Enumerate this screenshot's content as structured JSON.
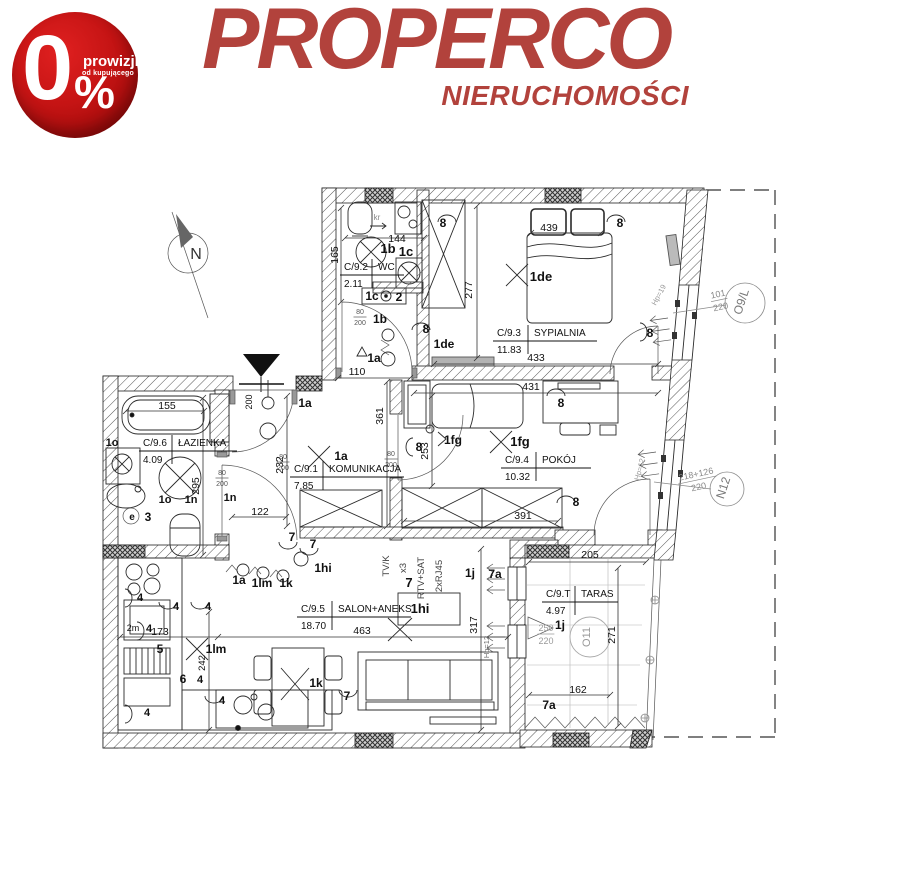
{
  "badge": {
    "zero": "0",
    "percent_sign": "%",
    "line1": "prowizji",
    "line2": "od kupującego",
    "bg": "#c51414"
  },
  "logo": {
    "title": "PROPERCO",
    "subtitle": "NIERUCHOMOŚCI",
    "color": "#b2423c"
  },
  "plan": {
    "compass_label": "N",
    "rooms": [
      {
        "code": "C/9.2",
        "name": "WC",
        "area": "2.11",
        "x": 344,
        "y": 270,
        "dx": 34,
        "lw": 60
      },
      {
        "code": "C/9.3",
        "name": "SYPIALNIA",
        "area": "11.83",
        "x": 497,
        "y": 336,
        "dx": 37,
        "lw": 100
      },
      {
        "code": "C/9.4",
        "name": "POKÓJ",
        "area": "10.32",
        "x": 505,
        "y": 463,
        "dx": 37,
        "lw": 86
      },
      {
        "code": "C/9.6",
        "name": "ŁAZIENKA",
        "area": "4.09",
        "x": 143,
        "y": 446,
        "dx": 35,
        "lw": 94
      },
      {
        "code": "C/9.1",
        "name": "KOMUNIKACJA",
        "area": "7.85",
        "x": 294,
        "y": 472,
        "dx": 35,
        "lw": 110
      },
      {
        "code": "C/9.5",
        "name": "SALON+ANEKS",
        "area": "18.70",
        "x": 301,
        "y": 612,
        "dx": 37,
        "lw": 110
      },
      {
        "code": "C/9.T",
        "name": "TARAS",
        "area": "4.97",
        "x": 546,
        "y": 597,
        "dx": 35,
        "lw": 72
      }
    ],
    "labels": [
      {
        "t": "144",
        "x": 397,
        "y": 242
      },
      {
        "t": "165",
        "x": 338,
        "y": 255,
        "r": -90
      },
      {
        "t": "110",
        "x": 357,
        "y": 375
      },
      {
        "t": "439",
        "x": 549,
        "y": 231
      },
      {
        "t": "277",
        "x": 472,
        "y": 290,
        "r": -90
      },
      {
        "t": "433",
        "x": 536,
        "y": 361
      },
      {
        "t": "431",
        "x": 531,
        "y": 390
      },
      {
        "t": "253",
        "x": 428,
        "y": 451,
        "r": -90
      },
      {
        "t": "361",
        "x": 383,
        "y": 416,
        "r": -90
      },
      {
        "t": "391",
        "x": 523,
        "y": 519
      },
      {
        "t": "155",
        "x": 167,
        "y": 409
      },
      {
        "t": "295",
        "x": 199,
        "y": 486,
        "r": -90
      },
      {
        "t": "232",
        "x": 283,
        "y": 465,
        "r": -90
      },
      {
        "t": "122",
        "x": 260,
        "y": 515
      },
      {
        "t": "200",
        "x": 252,
        "y": 402,
        "r": -90,
        "s": 9
      },
      {
        "t": "173",
        "x": 160,
        "y": 635
      },
      {
        "t": "242",
        "x": 205,
        "y": 663,
        "r": -90,
        "s": 9.5
      },
      {
        "t": "463",
        "x": 362,
        "y": 634
      },
      {
        "t": "317",
        "x": 477,
        "y": 625,
        "r": -90
      },
      {
        "t": "205",
        "x": 590,
        "y": 558
      },
      {
        "t": "271",
        "x": 615,
        "y": 635,
        "r": -90
      },
      {
        "t": "162",
        "x": 578,
        "y": 693
      },
      {
        "t": "1b",
        "x": 388,
        "y": 253,
        "b": 1,
        "s": 13
      },
      {
        "t": "1c",
        "x": 406,
        "y": 256,
        "b": 1,
        "s": 13
      },
      {
        "t": "1c",
        "x": 372,
        "y": 300,
        "b": 1,
        "s": 12
      },
      {
        "t": "2",
        "x": 399,
        "y": 301,
        "b": 1,
        "s": 12
      },
      {
        "t": "1b",
        "x": 380,
        "y": 323,
        "b": 1,
        "s": 12
      },
      {
        "t": "1a",
        "x": 374,
        "y": 362,
        "b": 1,
        "s": 12
      },
      {
        "t": "8",
        "x": 426,
        "y": 333,
        "b": 1,
        "s": 12
      },
      {
        "t": "1de",
        "x": 444,
        "y": 348,
        "b": 1,
        "s": 12
      },
      {
        "t": "8",
        "x": 443,
        "y": 227,
        "b": 1,
        "s": 12
      },
      {
        "t": "8",
        "x": 620,
        "y": 227,
        "b": 1,
        "s": 12
      },
      {
        "t": "1de",
        "x": 541,
        "y": 281,
        "b": 1,
        "s": 13
      },
      {
        "t": "8",
        "x": 650,
        "y": 337,
        "b": 1,
        "s": 12
      },
      {
        "t": "1a",
        "x": 305,
        "y": 407,
        "b": 1,
        "s": 12
      },
      {
        "t": "1a",
        "x": 341,
        "y": 460,
        "b": 1,
        "s": 12
      },
      {
        "t": "1fg",
        "x": 453,
        "y": 444,
        "b": 1,
        "s": 12
      },
      {
        "t": "1fg",
        "x": 520,
        "y": 446,
        "b": 1,
        "s": 13
      },
      {
        "t": "8",
        "x": 419,
        "y": 451,
        "b": 1,
        "s": 12
      },
      {
        "t": "8",
        "x": 561,
        "y": 407,
        "b": 1,
        "s": 12
      },
      {
        "t": "8",
        "x": 576,
        "y": 506,
        "b": 1,
        "s": 12
      },
      {
        "t": "1o",
        "x": 112,
        "y": 446,
        "b": 1,
        "s": 11
      },
      {
        "t": "1o",
        "x": 165,
        "y": 503,
        "b": 1,
        "s": 11
      },
      {
        "t": "1n",
        "x": 191,
        "y": 503,
        "b": 1,
        "s": 11
      },
      {
        "t": "1n",
        "x": 230,
        "y": 501,
        "b": 1,
        "s": 11
      },
      {
        "t": "e",
        "x": 132,
        "y": 520,
        "b": 1,
        "s": 10
      },
      {
        "t": "3",
        "x": 148,
        "y": 521,
        "b": 1,
        "s": 12
      },
      {
        "t": "4",
        "x": 140,
        "y": 601,
        "b": 1,
        "s": 11
      },
      {
        "t": "4",
        "x": 176,
        "y": 610,
        "b": 1,
        "s": 11
      },
      {
        "t": "4",
        "x": 208,
        "y": 610,
        "b": 1,
        "s": 11
      },
      {
        "t": "2m",
        "x": 133,
        "y": 631,
        "s": 9
      },
      {
        "t": "4",
        "x": 149,
        "y": 632,
        "b": 1,
        "s": 11
      },
      {
        "t": "5",
        "x": 160,
        "y": 653,
        "b": 1,
        "s": 12
      },
      {
        "t": "1lm",
        "x": 216,
        "y": 653,
        "b": 1,
        "s": 12
      },
      {
        "t": "6",
        "x": 183,
        "y": 683,
        "b": 1,
        "s": 12
      },
      {
        "t": "4",
        "x": 200,
        "y": 683,
        "b": 1,
        "s": 11
      },
      {
        "t": "4",
        "x": 222,
        "y": 704,
        "b": 1,
        "s": 11
      },
      {
        "t": "4",
        "x": 147,
        "y": 716,
        "b": 1,
        "s": 11
      },
      {
        "t": "1a",
        "x": 239,
        "y": 584,
        "b": 1,
        "s": 12
      },
      {
        "t": "1lm",
        "x": 262,
        "y": 587,
        "b": 1,
        "s": 12
      },
      {
        "t": "1k",
        "x": 286,
        "y": 587,
        "b": 1,
        "s": 12
      },
      {
        "t": "7",
        "x": 313,
        "y": 548,
        "b": 1,
        "s": 12
      },
      {
        "t": "1hi",
        "x": 323,
        "y": 572,
        "b": 1,
        "s": 12
      },
      {
        "t": "7",
        "x": 292,
        "y": 541,
        "b": 1,
        "s": 12
      },
      {
        "t": "1k",
        "x": 316,
        "y": 687,
        "b": 1,
        "s": 12
      },
      {
        "t": "7",
        "x": 347,
        "y": 700,
        "b": 1,
        "s": 12
      },
      {
        "t": "7",
        "x": 409,
        "y": 587,
        "b": 1,
        "s": 13
      },
      {
        "t": "1j",
        "x": 470,
        "y": 577,
        "b": 1,
        "s": 12
      },
      {
        "t": "7a",
        "x": 495,
        "y": 578,
        "b": 1,
        "s": 12
      },
      {
        "t": "1j",
        "x": 560,
        "y": 629,
        "b": 1,
        "s": 12
      },
      {
        "t": "7a",
        "x": 549,
        "y": 709,
        "b": 1,
        "s": 12
      },
      {
        "t": "1hi",
        "x": 420,
        "y": 613,
        "b": 1,
        "s": 13
      },
      {
        "t": "TV/K",
        "x": 389,
        "y": 566,
        "r": -90,
        "s": 9.5,
        "c": "#444"
      },
      {
        "t": "x3",
        "x": 406,
        "y": 568,
        "r": -90,
        "s": 9.5,
        "c": "#444"
      },
      {
        "t": "RTV+SAT",
        "x": 424,
        "y": 578,
        "r": -90,
        "s": 9.5,
        "c": "#444"
      },
      {
        "t": "2xRJ45",
        "x": 442,
        "y": 576,
        "r": -90,
        "s": 9.5,
        "c": "#444"
      },
      {
        "t": "kr",
        "x": 377,
        "y": 220,
        "s": 8,
        "c": "#888"
      },
      {
        "t": "Hp=12",
        "x": 489,
        "y": 647,
        "r": -90,
        "s": 7.5,
        "c": "#666"
      },
      {
        "t": "Hp=19",
        "x": 661,
        "y": 296,
        "r": -62,
        "s": 7.5,
        "c": "#999"
      },
      {
        "t": "Hp=12",
        "x": 642,
        "y": 470,
        "r": -75,
        "s": 7.5,
        "c": "#999"
      },
      {
        "t": "O9/L",
        "x": 745,
        "y": 303,
        "r": -72,
        "s": 12,
        "c": "#777"
      },
      {
        "t": "N12",
        "x": 727,
        "y": 489,
        "r": -72,
        "s": 12,
        "c": "#777"
      },
      {
        "t": "O11",
        "x": 590,
        "y": 637,
        "r": -90,
        "s": 11,
        "c": "#999"
      },
      {
        "t": "N",
        "x": 196,
        "y": 259,
        "s": 16,
        "c": "#333"
      }
    ],
    "fractions": [
      {
        "top": "80",
        "bot": "200",
        "x": 360,
        "y": 316,
        "s": 7
      },
      {
        "top": "80",
        "bot": "200",
        "x": 283,
        "y": 461,
        "s": 7
      },
      {
        "top": "80",
        "bot": "200",
        "x": 222,
        "y": 477,
        "s": 7
      },
      {
        "top": "80",
        "bot": "200",
        "x": 391,
        "y": 458,
        "s": 7
      },
      {
        "top": "101",
        "bot": "220",
        "x": 719,
        "y": 299,
        "r": -12,
        "s": 9,
        "c": "#888"
      },
      {
        "top": "218+126",
        "bot": "220",
        "x": 697,
        "y": 479,
        "r": -12,
        "s": 9,
        "c": "#888"
      },
      {
        "top": "250",
        "bot": "220",
        "x": 546,
        "y": 633,
        "s": 9,
        "c": "#9a9a9a"
      }
    ],
    "colors": {
      "line": "#1c1c1c",
      "gray": "#777"
    }
  }
}
